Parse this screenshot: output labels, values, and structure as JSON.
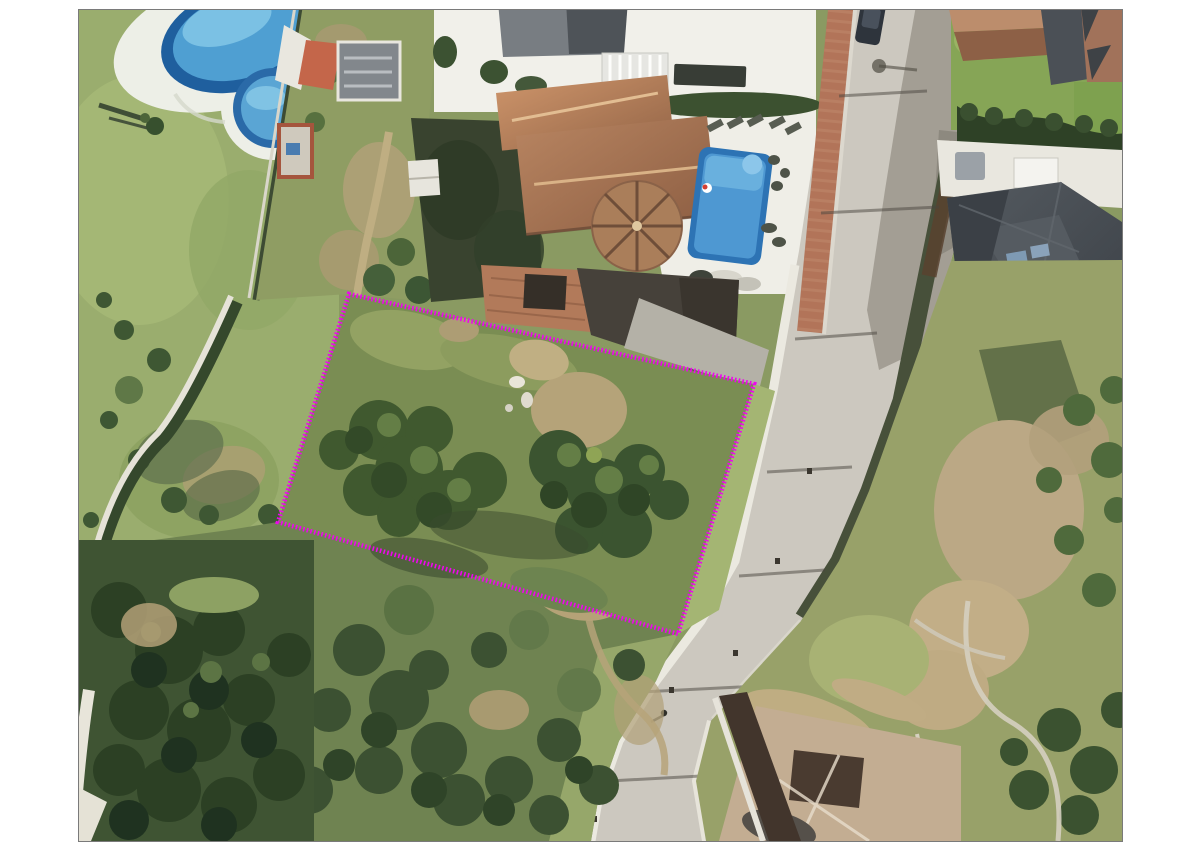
{
  "meta": {
    "kind": "aerial-satellite-photo",
    "description": "Aerial view of a vacant residential building plot outlined in dotted magenta, bounded by a curving street on the east, a community pool garden on the west, a villa with pool to the north and scrubland to the south and east."
  },
  "frame": {
    "background": "#ffffff",
    "border_color": "#7a7a7a",
    "x_px": 78,
    "y_px": 9,
    "width_px": 1043,
    "height_px": 831
  },
  "overlay": {
    "plot_boundary": {
      "shape": "quadrilateral",
      "stroke_color": "#ee06ee",
      "stroke_style": "dotted",
      "stroke_width_px": 4.6,
      "dash_pattern": "1.6 2.2",
      "points_px": "270,284 675,374 599,624 199,512",
      "corners_full_image_px": [
        [
          348,
          293
        ],
        [
          753,
          383
        ],
        [
          677,
          633
        ],
        [
          277,
          521
        ]
      ]
    }
  },
  "palette": {
    "road": "#ccc8bf",
    "road_shadow": "#a39e94",
    "curb_white": "#ebe9e0",
    "brick_sidewalk": "#b27459",
    "hedge_band": "#47503a",
    "pool_ring": "#2a6aa8",
    "pool_water": "#4f9fd2",
    "pool_highlight": "#7fc4e6",
    "villa_pool": "#4e98d2",
    "deck_white": "#efeee7",
    "lawn": "#9aad6e",
    "plot_scrub": "#7a8d53",
    "dry_ground": "#b5a379",
    "trees_dark": "#2f4428",
    "roof_terracotta": "#b5825f",
    "roof_slate": "#474c52",
    "woodland": "#3f5433"
  },
  "landmarks": {
    "community_pool": "kidney-shaped community pool with round kids pool, top left",
    "villa_with_pool": "terracotta-roof villa with round gazebo roof and rectangular pool, top centre",
    "flat_roof_building": "grey flat-roof building, top centre",
    "street": "curving residential street from top right to bottom centre",
    "north_east_houses": "terracotta-roof houses and slate-roof mansion, top right",
    "plot": "vacant tree-covered plot outlined in magenta, centre left",
    "east_scrubland": "dry scrubland with stone walls, right side",
    "south_house": "pale-roof house beside road, bottom centre",
    "south_woodland": "dense dark trees, bottom left"
  }
}
